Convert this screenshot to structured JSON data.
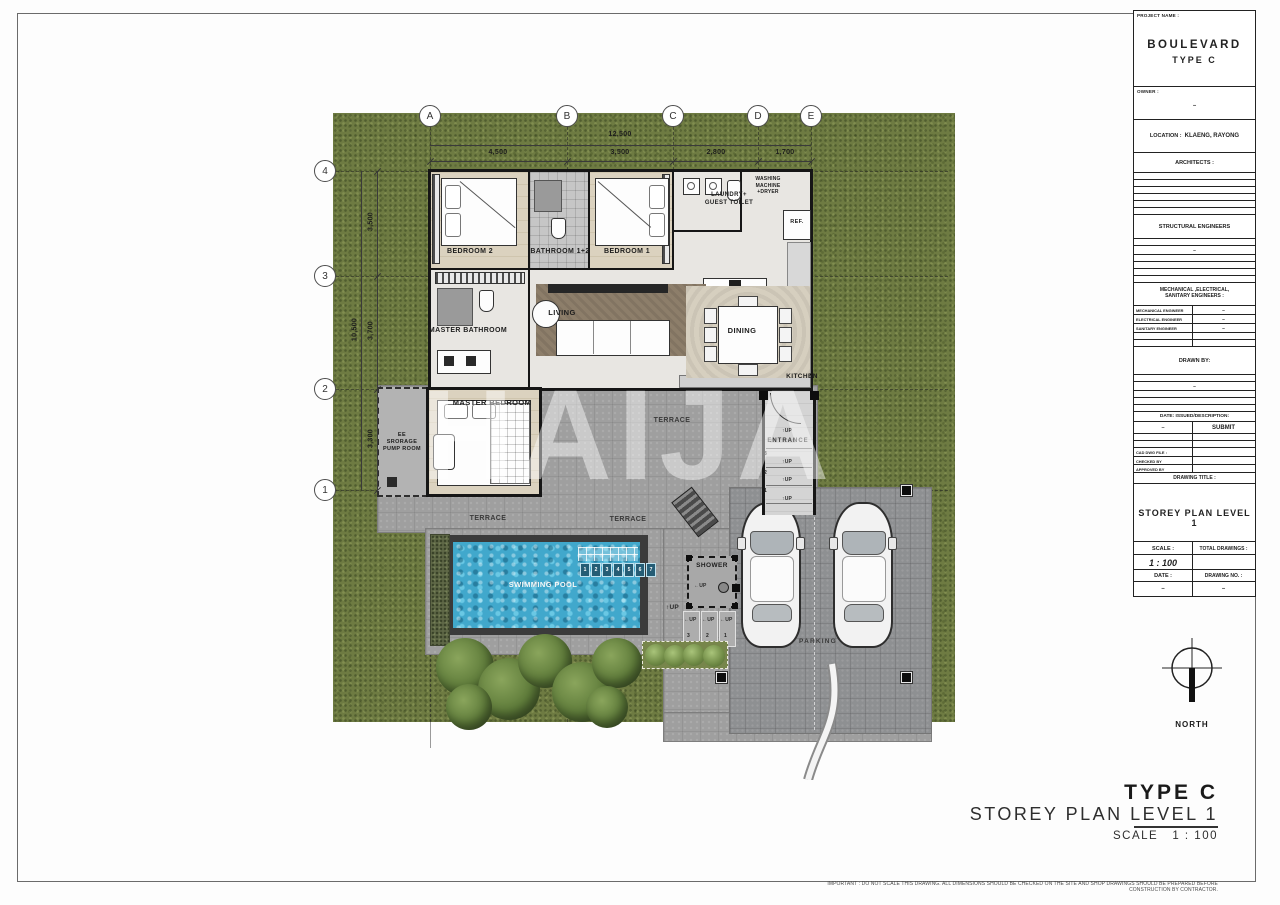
{
  "watermark": "HAIJA",
  "plan": {
    "grid": {
      "columns": [
        "A",
        "B",
        "C",
        "D",
        "E"
      ],
      "rows": [
        "4",
        "3",
        "2",
        "1"
      ],
      "top_total": "12,500",
      "top_segments": [
        "4,500",
        "3,500",
        "2,800",
        "1,700"
      ],
      "left_total": "10,500",
      "left_segments": [
        "3,500",
        "3,700",
        "3,300"
      ]
    },
    "rooms": {
      "bedroom2": "BEDROOM 2",
      "bathroom12": "BATHROOM 1+2",
      "bedroom1": "BEDROOM 1",
      "laundry": "LAUNDRY+\nGUEST TOILET",
      "washing_machine": "WASHING\nMACHINE\n+DRYER",
      "ref": "REF.",
      "master_bathroom": "MASTER BATHROOM",
      "living": "LIVING",
      "dining": "DINING",
      "kitchen": "KITCHEN",
      "master_bedroom": "MASTER BEDROOM",
      "storage": "EE\nSRORAGE\nPUMP ROOM",
      "terrace_upper": "TERRACE",
      "terrace_lower_left": "TERRACE",
      "terrace_lower_mid": "TERRACE",
      "entrance": "ENTRANCE",
      "swimming_pool": "SWIMMING POOL",
      "shower": "SHOWER",
      "parking": "PARKING"
    },
    "annotations": {
      "up": "UP",
      "arrow_up": "↑",
      "arrow_left": "←",
      "entrance_steps": [
        "3",
        "2",
        "1"
      ],
      "outdoor_steps": [
        "3",
        "2",
        "1"
      ],
      "pool_steps": [
        "1",
        "2",
        "3",
        "4",
        "5",
        "6",
        "7"
      ]
    }
  },
  "title_block": {
    "project_name_label": "PROJECT NAME :",
    "project_name": "BOULEVARD",
    "project_type": "TYPE C",
    "owner_label": "OWNER :",
    "owner_value": "–",
    "location_label": "LOCATION :",
    "location_value": "KLAENG, RAYONG",
    "architects_label": "ARCHITECTS :",
    "structural_label": "STRUCTURAL ENGINEERS",
    "structural_value": "–",
    "mes_label": "MECHANICAL ,ELECTRICAL,\nSANITARY ENGINEERS :",
    "engineers": [
      {
        "label": "MECHANICAL ENGINEER",
        "value": "–"
      },
      {
        "label": "ELECTRICAL ENGINEER",
        "value": "–"
      },
      {
        "label": "SANITARY ENGINEER",
        "value": "–"
      }
    ],
    "drawn_by_label": "DRAWN BY:",
    "drawn_by_value": "–",
    "date_issued_label": "DATE: ISSUED/DESCRIPTION:",
    "issue_date": "–",
    "issue_description": "SUBMIT",
    "cad_file_label": "CAD DWG FILE :",
    "checked_by_label": "CHECKED BY",
    "approved_by_label": "APPROVED BY",
    "drawing_title_label": "DRAWING TITLE :",
    "drawing_title": "STOREY PLAN LEVEL 1",
    "scale_label": "SCALE :",
    "scale_value": "1 : 100",
    "total_drawings_label": "TOTAL DRAWINGS :",
    "date_label": "DATE :",
    "date_value": "–",
    "drawing_no_label": "DRAWING NO. :",
    "drawing_no_value": "–"
  },
  "north_label": "NORTH",
  "footer": {
    "type": "TYPE C",
    "title": "STOREY PLAN LEVEL 1",
    "scale_label": "SCALE",
    "scale_value": "1 : 100"
  },
  "disclaimer": "IMPORTANT : DO NOT SCALE THIS DRAWING. ALL DIMENSIONS SHOULD BE CHECKED ON THE SITE AND SHOP DRAWINGS SHOULD BE PREPARED BEFORE CONSTRUCTION BY CONTRACTOR.",
  "colors": {
    "grass": "#6e7b42",
    "paving": "#9c9c9c",
    "pool_water": "#41a8cc",
    "wall": "#161616"
  }
}
